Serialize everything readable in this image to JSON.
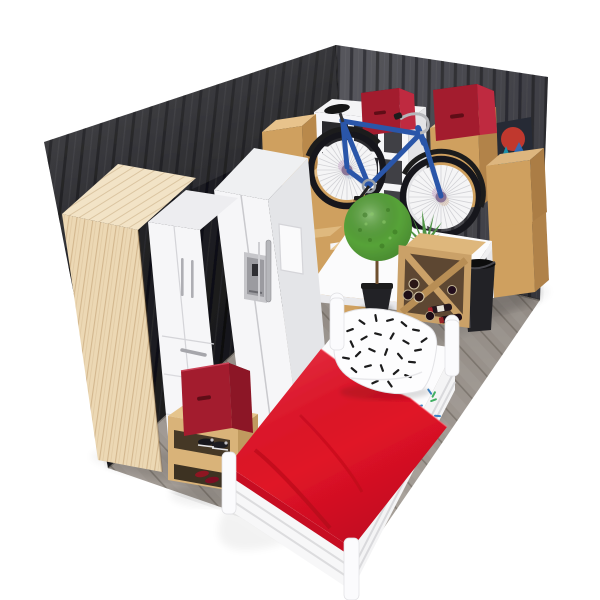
{
  "scene": {
    "title": "3D isometric storage-unit room render",
    "width": 600,
    "height": 600,
    "background": "#ffffff",
    "outline_glow": "#ffffff"
  },
  "colors": {
    "wall_left": "#232328",
    "wall_right": "#4f4f55",
    "floor": "#9a938c",
    "wood": "#ecd8b4",
    "wood_top": "#f2e3c6",
    "bench_wood": "#d9b379",
    "white_furniture": "#f6f6f8",
    "cardboard": "#cfa05e",
    "cardboard_top": "#e6c08b",
    "bin_red": "#a31b2f",
    "bin_red_side": "#bf2c40",
    "bin_red_interior": "#6a0d1c",
    "duvet_red": "#e01226",
    "bike_blue": "#2a57a9",
    "tire_black": "#18181b",
    "plant_green": "#57a339",
    "aloe_green": "#4f9444",
    "pot_black": "#222225",
    "trash_black": "#242428",
    "rack_wood": "#caa168",
    "rack_interior": "#5d4730",
    "metal": "#b4b4b8",
    "art_bg": "#262b34",
    "art_red": "#c0392e",
    "art_teal": "#1f8fa8",
    "art_blue": "#2b6fc0",
    "pillow_dash": "#1a1a1d",
    "sheet_dash_blue": "#3b82c4",
    "sheet_dash_green": "#3fae62"
  },
  "room": {
    "walls": [
      {
        "side": "left",
        "finish": "dark vertical metal panels"
      },
      {
        "side": "right",
        "finish": "gray vertical metal panels"
      }
    ],
    "floor": {
      "finish": "gray wood planks"
    }
  },
  "objects": {
    "wood_wardrobe": {
      "label": "tall light-wood wardrobe"
    },
    "white_wardrobe": {
      "label": "white wardrobe, 2 doors + drawers"
    },
    "refrigerator": {
      "label": "white side-by-side fridge with water dispenser"
    },
    "cube_shelf": {
      "label": "white open cube shelving unit"
    },
    "storage_bins": {
      "label": "red fabric storage bins",
      "count": 3
    },
    "cardboard_boxes": {
      "label": "cardboard moving boxes",
      "count": 7
    },
    "bicycle": {
      "label": "blue bicycle leaning on shelf"
    },
    "wall_art": {
      "label": "mountain landscape canvas leaning on right wall"
    },
    "table": {
      "label": "white table"
    },
    "topiary_plant": {
      "label": "round topiary in black pot"
    },
    "aloe_plant": {
      "label": "aloe plant on table"
    },
    "wine_rack": {
      "label": "wooden X wine rack",
      "bottles": 7
    },
    "trash_bin": {
      "label": "black trash bin"
    },
    "bed": {
      "label": "single bed, white frame",
      "duvet": "red",
      "pillow": "white with black confetti pattern",
      "sheet": "white with blue dashes"
    },
    "shoe_bench": {
      "label": "wooden shoe bench",
      "shoes": "black sneakers + dark red shoes"
    }
  }
}
